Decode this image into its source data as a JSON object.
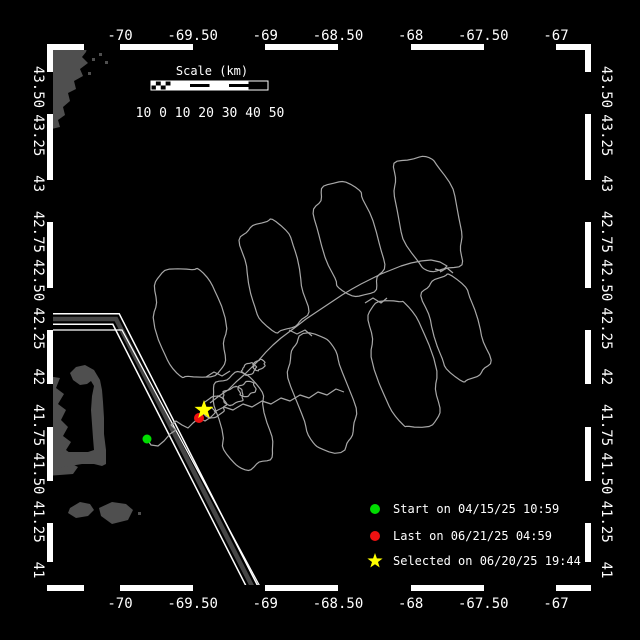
{
  "figure": {
    "bg": "#000000",
    "fg": "#ffffff"
  },
  "axes": {
    "lon_labels": [
      "-70",
      "-69.50",
      "-69",
      "-68.50",
      "-68",
      "-67.50",
      "-67"
    ],
    "lat_labels": [
      "43.50",
      "43.25",
      "43",
      "42.75",
      "42.50",
      "42.25",
      "42",
      "41.75",
      "41.50",
      "41.25",
      "41"
    ]
  },
  "scale_bar": {
    "title": "Scale (km)",
    "numbers": "10 0 10 20 30 40 50"
  },
  "legend": [
    {
      "marker": "circle",
      "color": "#00dd00",
      "label": "Start on 04/15/25 10:59"
    },
    {
      "marker": "circle",
      "color": "#ee1111",
      "label": "Last on 06/21/25 04:59"
    },
    {
      "marker": "star",
      "color": "#ffff00",
      "label": "Selected on 06/20/25 19:44"
    }
  ],
  "markers": {
    "start": {
      "x": 147,
      "y": 439,
      "color": "#00dd00"
    },
    "last": {
      "x": 199,
      "y": 418,
      "color": "#ee1111"
    },
    "selected": {
      "x": 204,
      "y": 410,
      "color": "#ffff00"
    }
  },
  "map": {
    "land_color": "#4f4f4f",
    "track_color": "#a8a8a8",
    "land": [
      [
        [
          47,
          44
        ],
        [
          88,
          44
        ],
        [
          86,
          52
        ],
        [
          82,
          57
        ],
        [
          88,
          63
        ],
        [
          80,
          69
        ],
        [
          83,
          76
        ],
        [
          74,
          81
        ],
        [
          76,
          89
        ],
        [
          68,
          93
        ],
        [
          70,
          101
        ],
        [
          63,
          107
        ],
        [
          65,
          115
        ],
        [
          58,
          120
        ],
        [
          60,
          127
        ],
        [
          47,
          130
        ]
      ],
      [
        [
          47,
          376
        ],
        [
          60,
          378
        ],
        [
          56,
          388
        ],
        [
          64,
          394
        ],
        [
          58,
          404
        ],
        [
          66,
          410
        ],
        [
          61,
          420
        ],
        [
          68,
          427
        ],
        [
          63,
          436
        ],
        [
          71,
          442
        ],
        [
          66,
          450
        ],
        [
          74,
          456
        ],
        [
          70,
          463
        ],
        [
          78,
          467
        ],
        [
          73,
          474
        ],
        [
          47,
          476
        ]
      ],
      [
        [
          58,
          468
        ],
        [
          70,
          466
        ],
        [
          82,
          464
        ],
        [
          94,
          464
        ],
        [
          102,
          466
        ],
        [
          106,
          464
        ],
        [
          106,
          450
        ],
        [
          104,
          434
        ],
        [
          104,
          418
        ],
        [
          103,
          402
        ],
        [
          102,
          390
        ],
        [
          100,
          380
        ],
        [
          94,
          370
        ],
        [
          85,
          365
        ],
        [
          76,
          367
        ],
        [
          70,
          373
        ],
        [
          73,
          380
        ],
        [
          80,
          385
        ],
        [
          87,
          384
        ],
        [
          91,
          381
        ],
        [
          94,
          386
        ],
        [
          92,
          396
        ],
        [
          91,
          410
        ],
        [
          92,
          424
        ],
        [
          93,
          438
        ],
        [
          94,
          450
        ],
        [
          88,
          452
        ],
        [
          76,
          452
        ],
        [
          66,
          452
        ],
        [
          58,
          455
        ]
      ],
      [
        [
          70,
          508
        ],
        [
          80,
          502
        ],
        [
          90,
          504
        ],
        [
          94,
          510
        ],
        [
          88,
          516
        ],
        [
          76,
          518
        ],
        [
          68,
          513
        ]
      ],
      [
        [
          99,
          508
        ],
        [
          112,
          502
        ],
        [
          126,
          504
        ],
        [
          133,
          510
        ],
        [
          128,
          520
        ],
        [
          112,
          524
        ],
        [
          101,
          516
        ]
      ]
    ],
    "land_dots": [
      [
        92,
        58
      ],
      [
        99,
        53
      ],
      [
        105,
        61
      ],
      [
        88,
        72
      ],
      [
        138,
        512
      ]
    ],
    "lane": {
      "gray": "#454545",
      "center": [
        [
          44,
          319
        ],
        [
          116,
          319
        ],
        [
          256,
          594
        ]
      ],
      "extra": [
        [
          44,
          330
        ],
        [
          122,
          330
        ],
        [
          264,
          594
        ]
      ]
    },
    "track_rings": [
      [
        190,
        323,
        112,
        66,
        13,
        1
      ],
      [
        274,
        276,
        112,
        54,
        14,
        2
      ],
      [
        349,
        239,
        114,
        56,
        15,
        3
      ],
      [
        428,
        214,
        118,
        58,
        16,
        4
      ],
      [
        243,
        421,
        96,
        50,
        14,
        5
      ],
      [
        322,
        393,
        118,
        54,
        15,
        6
      ],
      [
        404,
        364,
        132,
        56,
        16,
        7
      ],
      [
        456,
        328,
        108,
        48,
        19,
        8
      ],
      [
        214,
        407,
        18,
        24,
        40,
        9
      ],
      [
        233,
        396,
        16,
        20,
        30,
        10
      ],
      [
        247,
        389,
        13,
        17,
        25,
        11
      ],
      [
        249,
        369,
        10,
        14,
        35,
        12
      ],
      [
        259,
        365,
        9,
        12,
        35,
        13
      ]
    ],
    "track_lines": [
      [
        [
          147,
          439
        ],
        [
          151,
          445
        ],
        [
          158,
          446
        ],
        [
          164,
          441
        ],
        [
          170,
          434
        ],
        [
          176,
          430
        ],
        [
          171,
          425
        ],
        [
          176,
          421
        ],
        [
          182,
          425
        ],
        [
          188,
          428
        ],
        [
          193,
          423
        ],
        [
          199,
          418
        ],
        [
          205,
          421
        ],
        [
          211,
          417
        ],
        [
          216,
          412
        ],
        [
          211,
          407
        ],
        [
          205,
          411
        ],
        [
          201,
          416
        ]
      ],
      [
        [
          210,
          403
        ],
        [
          219,
          396
        ],
        [
          228,
          390
        ],
        [
          236,
          382
        ],
        [
          244,
          375
        ],
        [
          252,
          367
        ],
        [
          259,
          360
        ],
        [
          266,
          352
        ],
        [
          273,
          345
        ],
        [
          281,
          338
        ],
        [
          289,
          332
        ],
        [
          297,
          326
        ],
        [
          306,
          319
        ],
        [
          315,
          313
        ],
        [
          324,
          307
        ],
        [
          333,
          301
        ],
        [
          342,
          295
        ],
        [
          352,
          289
        ],
        [
          361,
          284
        ],
        [
          371,
          279
        ],
        [
          381,
          274
        ],
        [
          391,
          270
        ],
        [
          401,
          266
        ],
        [
          411,
          263
        ],
        [
          421,
          261
        ],
        [
          431,
          260
        ],
        [
          440,
          262
        ],
        [
          447,
          266
        ],
        [
          442,
          271
        ],
        [
          435,
          269
        ]
      ],
      [
        [
          214,
          412
        ],
        [
          224,
          407
        ],
        [
          233,
          410
        ],
        [
          243,
          404
        ],
        [
          252,
          407
        ],
        [
          262,
          401
        ],
        [
          271,
          404
        ],
        [
          281,
          398
        ],
        [
          290,
          401
        ],
        [
          300,
          395
        ],
        [
          309,
          398
        ],
        [
          318,
          392
        ],
        [
          327,
          395
        ],
        [
          336,
          389
        ],
        [
          344,
          392
        ]
      ],
      [
        [
          206,
          377
        ],
        [
          214,
          372
        ],
        [
          222,
          376
        ],
        [
          230,
          371
        ]
      ],
      [
        [
          289,
          330
        ],
        [
          297,
          334
        ],
        [
          305,
          330
        ],
        [
          312,
          336
        ]
      ],
      [
        [
          365,
          303
        ],
        [
          373,
          298
        ],
        [
          381,
          303
        ],
        [
          387,
          298
        ]
      ],
      [
        [
          440,
          272
        ],
        [
          447,
          268
        ],
        [
          453,
          273
        ]
      ]
    ]
  },
  "_layout": {
    "frame": {
      "x1": 53,
      "y1": 50,
      "x2": 585,
      "y2": 585,
      "band": 6
    },
    "lon_ticks_px": [
      120,
      192.7,
      265.3,
      338,
      410.7,
      483.3,
      556
    ],
    "lat_ticks_px": [
      87,
      135.3,
      183.6,
      231.9,
      280.2,
      328.5,
      376.8,
      425.1,
      473.4,
      521.7,
      570
    ],
    "zebra_lon_black": [
      [
        84,
        120
      ],
      [
        193,
        265
      ],
      [
        338,
        411
      ],
      [
        484,
        556
      ]
    ],
    "zebra_lat_black": [
      [
        72,
        114
      ],
      [
        180,
        222
      ],
      [
        288,
        330
      ],
      [
        384,
        427
      ],
      [
        481,
        523
      ],
      [
        562,
        585
      ]
    ],
    "scale_bar": {
      "x": 151,
      "y": 81,
      "w": 117,
      "h": 9,
      "title_x": 212,
      "title_y": 75,
      "num_x": 210,
      "num_y": 117
    },
    "legend": {
      "marker_x": 375,
      "text_x": 393,
      "rows_y": [
        509,
        536,
        561
      ]
    },
    "axis_label_y_top": 40,
    "axis_label_y_bottom": 608,
    "axis_label_x_left": 34,
    "axis_label_x_right": 602
  }
}
